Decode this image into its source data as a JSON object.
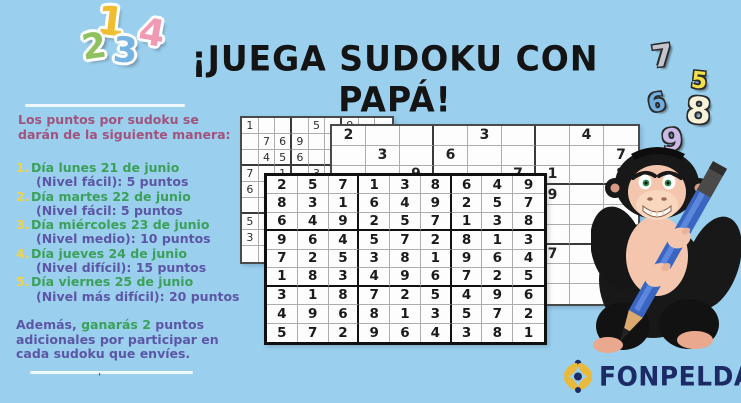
{
  "title": "¡JUEGA SUDOKU CON PAPÁ!",
  "decorative_numbers": {
    "top_left": [
      {
        "char": "1",
        "color": "#f0bd2e"
      },
      {
        "char": "2",
        "color": "#8fc15e"
      },
      {
        "char": "3",
        "color": "#74b4e3"
      },
      {
        "char": "4",
        "color": "#f09ab3"
      }
    ],
    "right": [
      {
        "char": "7",
        "color": "#c4c4cf"
      },
      {
        "char": "5",
        "color": "#f2e14a"
      },
      {
        "char": "6",
        "color": "#70aede"
      },
      {
        "char": "8",
        "color": "#f7f2da"
      },
      {
        "char": "9",
        "color": "#cbb9e6"
      }
    ]
  },
  "info_panel": {
    "intro": "Los puntos por sudoku se darán de la siguiente manera:",
    "items": [
      {
        "num": "1.",
        "day": "Día lunes 21 de junio",
        "level": "(Nivel fácil): 5 puntos"
      },
      {
        "num": "2.",
        "day": "Día martes 22 de junio",
        "level": "(Nivel fácil: 5 puntos"
      },
      {
        "num": "3.",
        "day": "Día miércoles 23 de junio",
        "level": "(Nivel medio): 10 puntos"
      },
      {
        "num": "4.",
        "day": "Día jueves 24 de junio",
        "level": "(Nivel difícil): 15 puntos"
      },
      {
        "num": "5.",
        "day": "Día viernes 25 de junio",
        "level": "(Nivel más difícil): 20 puntos"
      }
    ],
    "footer_part1": "Además,",
    "footer_green": " ganarás 2 ",
    "footer_part2": "puntos adicionales por participar en cada sudoku que envíes.",
    "footnote_mark": "'"
  },
  "sudoku": {
    "back_left_rows": [
      "1...5.9..",
      ".769.....",
      ".456..3..",
      "7.1.3....",
      "6........",
      ".........",
      "5........",
      "3........",
      "........."
    ],
    "back_right_rows": [
      "2...3..4.",
      ".3.6....7",
      "..9..71.8",
      "......9..",
      ".........",
      ".........",
      "......7..",
      ".........",
      "........."
    ],
    "front_rows": [
      "257138649",
      "831649257",
      "649257138",
      "964572813",
      "725381964",
      "183496725",
      "318725496",
      "496813572",
      "572964381"
    ]
  },
  "mascot": {
    "name": "gorilla-with-blue-pencil"
  },
  "logo": {
    "text": "FONPELDAR"
  },
  "colors": {
    "background": "#9ad0ee",
    "title": "#141414",
    "intro": "#a2537d",
    "list_number": "#f0d34a",
    "day_green": "#3ba158",
    "level_purple": "#5d56a6",
    "logo_navy": "#1c2b66",
    "logo_yellow": "#e9b93b",
    "pencil_blue": "#3a66c2"
  }
}
